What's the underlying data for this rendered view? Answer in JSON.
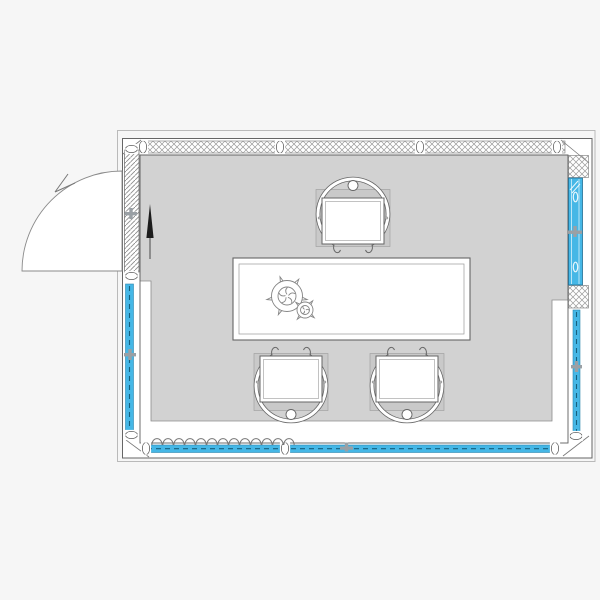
{
  "meta": {
    "title": "Architectural floor plan — glazed meeting room",
    "drawing_type": "2D CAD plan view"
  },
  "colors": {
    "background": "#f6f6f6",
    "floor": "#d2d2d2",
    "chair_base": "#c9c9c9",
    "wall_line": "#5f5f5f",
    "hatch_line": "#9a9a9a",
    "glazing_blue": "#45b7e6",
    "glazing_dark": "#1f7ca6",
    "north_arrow": "#1c1c1c",
    "white": "#ffffff"
  },
  "plan": {
    "room": {
      "name": "meeting-room",
      "shape": "rectangular"
    },
    "walls": {
      "top": {
        "type": "solid-partition",
        "hatch": "crosshatch",
        "joints": 4
      },
      "left": {
        "segments": [
          "hinged-door-panel (hatched)",
          "glazed-strip (blue)"
        ]
      },
      "right": {
        "segments": [
          "crosshatch-post",
          "glazed-panel (solid blue)",
          "crosshatch-post",
          "glazed-strip (blue)"
        ]
      },
      "bottom": {
        "type": "glazed-strip (blue)",
        "joints": 3
      }
    },
    "door": {
      "type": "single-swing-door",
      "wall": "left",
      "swing": "opens outward to the left, quarter-circle arc with direction arrow"
    },
    "furniture": {
      "table": {
        "type": "rectangular-conference-table"
      },
      "plant": {
        "type": "potted-plant-pair",
        "location": "left end of table"
      },
      "chairs": [
        {
          "position": "north side of table",
          "transform": "translate(353,218) rotate(0)"
        },
        {
          "position": "south side, left",
          "transform": "translate(291,382) rotate(180)"
        },
        {
          "position": "south side, right",
          "transform": "translate(407,382) rotate(180)"
        }
      ]
    },
    "annotations": {
      "north_arrow": "black arrow pointing up, inside room near door",
      "curtain": "loop (coil) symbol along bottom-left glazing"
    }
  }
}
